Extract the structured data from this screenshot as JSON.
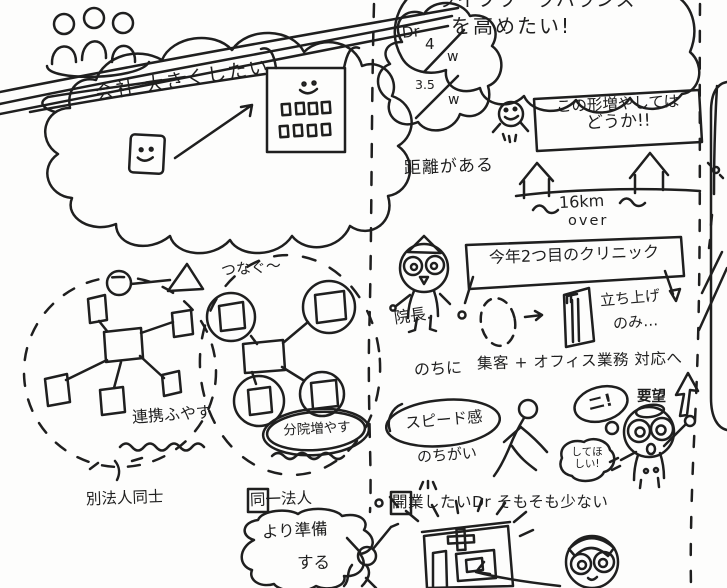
{
  "colors": {
    "ink": "#1f1f1f",
    "pink": "#ee9dbb",
    "cyan": "#a5dae6",
    "orange": "#f0a64a",
    "bg": "#fdfdfc"
  },
  "left_panel": {
    "company_goal": "会社 大きくしたい",
    "left_network_label": "連携ふやす",
    "left_network_sub": "別法人同士",
    "right_network_top": "つなぐ〜",
    "right_network_label": "分院増やす",
    "right_network_sub": "同一法人",
    "prep_line1": "より準備",
    "prep_line2": "する"
  },
  "right_panel": {
    "wlb_line1": "ライフワークバランス",
    "wlb_line2": "を高めたい!",
    "dr_label": "Dr",
    "dr_value1": "4",
    "dr_unit1": "w",
    "dr_value2": "3.5",
    "dr_unit2": "w",
    "suggestion_line1": "この形増やしては",
    "suggestion_line2": "どうか!!",
    "distance_label": "距離がある",
    "distance_value": "16km",
    "distance_over": "over",
    "clinic_box_label": "今年2つ目のクリニック",
    "director_label": "院長.",
    "launch_line1": "立ち上げ",
    "launch_line2": "のみ…",
    "later_prefix": "のちに",
    "later_text": "集客 + オフィス業務 対応へ",
    "request_label": "要望",
    "speed_label": "スピード感",
    "speed_sub": "のちがい",
    "bubble_exclaim": "ニ!",
    "bubble_request_l1": "してほ",
    "bubble_request_l2": "しい!",
    "bottom_bullet": "●",
    "bottom_note": "開業したいDr そもそも少ない"
  }
}
